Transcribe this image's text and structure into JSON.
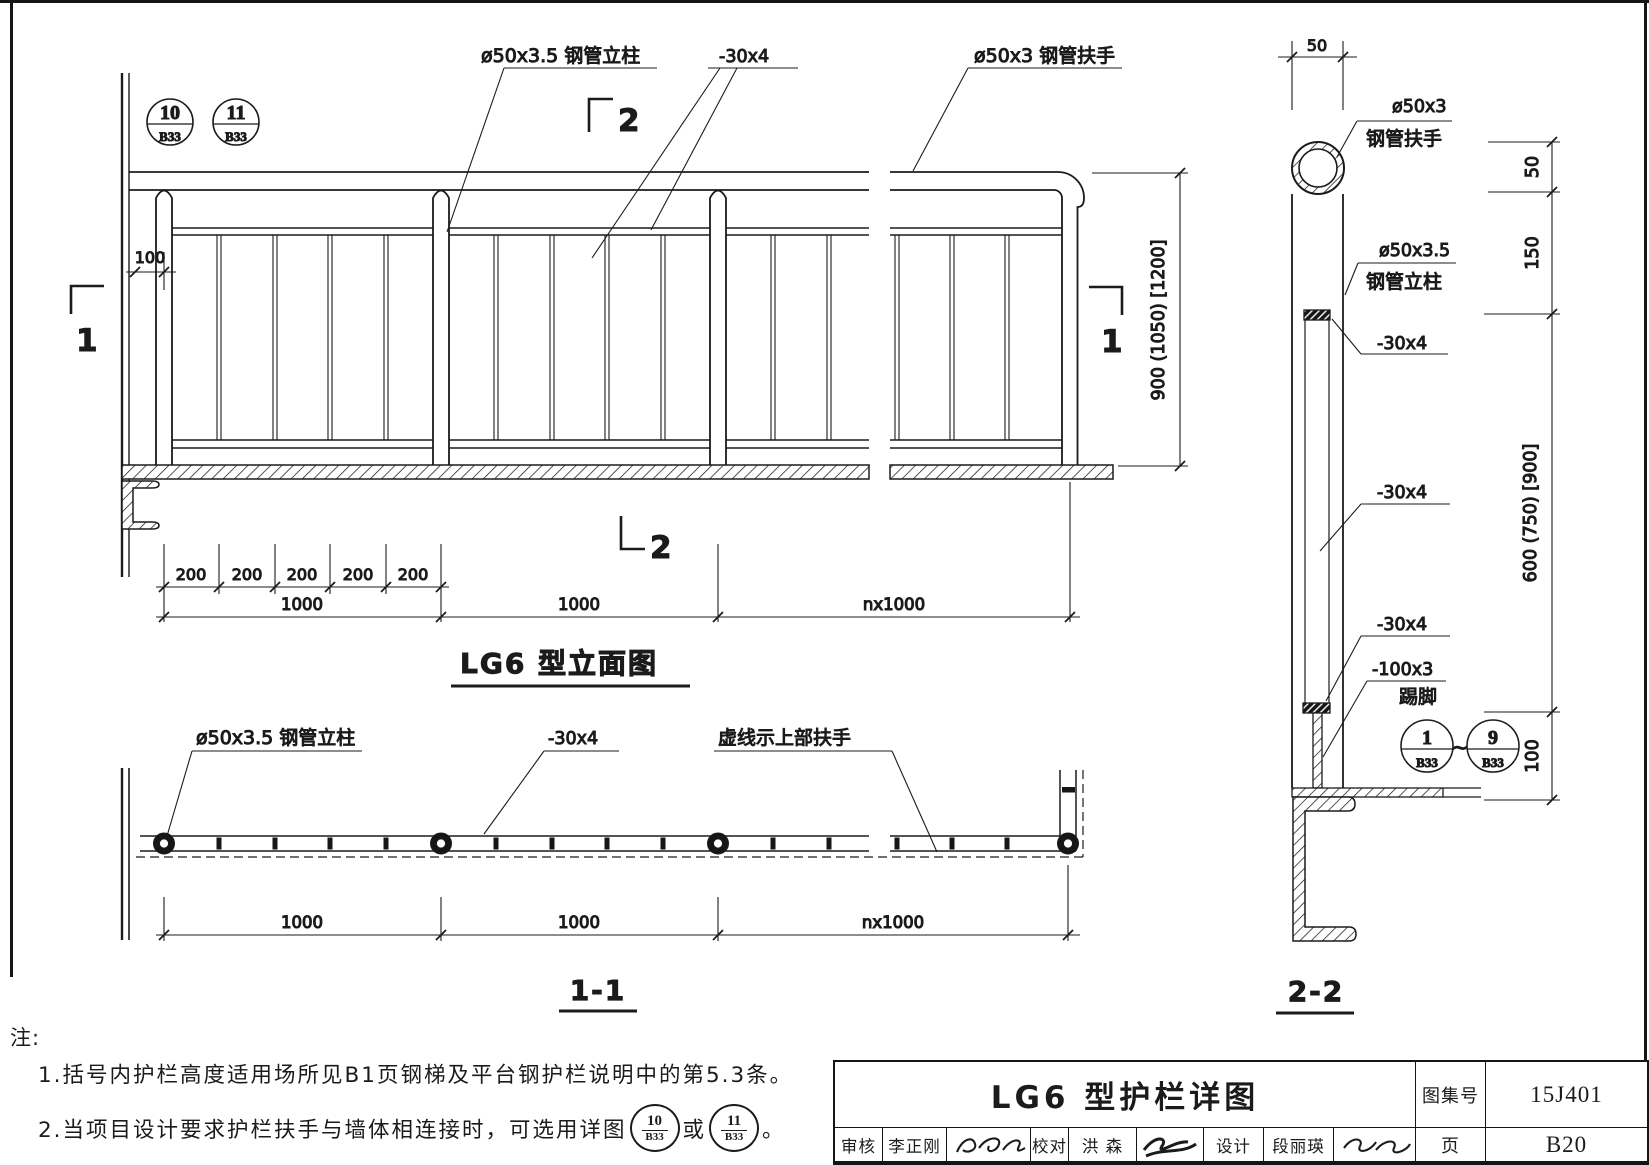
{
  "elevation": {
    "title": "LG6 型立面图",
    "detail_bubbles": [
      {
        "num": "10",
        "sheet": "B33"
      },
      {
        "num": "11",
        "sheet": "B33"
      }
    ],
    "labels": {
      "post": "ø50x3.5 钢管立柱",
      "flat_bar": "-30x4",
      "handrail": "ø50x3 钢管扶手"
    },
    "section_marks": {
      "one": "1",
      "two": "2"
    },
    "dims": {
      "offset": "100",
      "spacing": [
        "200",
        "200",
        "200",
        "200",
        "200"
      ],
      "bays": [
        "1000",
        "1000",
        "nx1000"
      ],
      "height": "900 (1050) [1200]"
    }
  },
  "plan": {
    "title": "1-1",
    "labels": {
      "post": "ø50x3.5 钢管立柱",
      "flat_bar": "-30x4",
      "dashed": "虚线示上部扶手"
    },
    "dims": {
      "bays": [
        "1000",
        "1000",
        "nx1000"
      ]
    }
  },
  "section": {
    "title": "2-2",
    "labels": {
      "handrail_size": "ø50x3",
      "handrail_name": "钢管扶手",
      "post_size": "ø50x3.5",
      "post_name": "钢管立柱",
      "flat_top": "-30x4",
      "flat_mid": "-30x4",
      "flat_bottom": "-30x4",
      "kick_size": "-100x3",
      "kick_name": "踢脚"
    },
    "detail_range": {
      "from": {
        "num": "1",
        "sheet": "B33"
      },
      "tilde": "~",
      "to": {
        "num": "9",
        "sheet": "B33"
      }
    },
    "dims": {
      "top": "50",
      "right": [
        "50",
        "150",
        "600 (750) [900]",
        "100"
      ]
    }
  },
  "notes": {
    "head": "注:",
    "item1": "1.括号内护栏高度适用场所见B1页钢梯及平台钢护栏说明中的第5.3条。",
    "item2_prefix": "2.当项目设计要求护栏扶手与墙体相连接时，可选用详图",
    "item2_or": "或",
    "item2_suffix": "。",
    "bubble_a": {
      "num": "10",
      "sheet": "B33"
    },
    "bubble_b": {
      "num": "11",
      "sheet": "B33"
    }
  },
  "titleblock": {
    "drawing_title": "LG6 型护栏详图",
    "atlas_label": "图集号",
    "atlas_no": "15J401",
    "page_label": "页",
    "page_no": "B20",
    "roles": {
      "review": "审核",
      "reviewer": "李正刚",
      "proof": "校对",
      "proofer": "洪  森",
      "design": "设计",
      "designer": "段丽瑛"
    }
  }
}
